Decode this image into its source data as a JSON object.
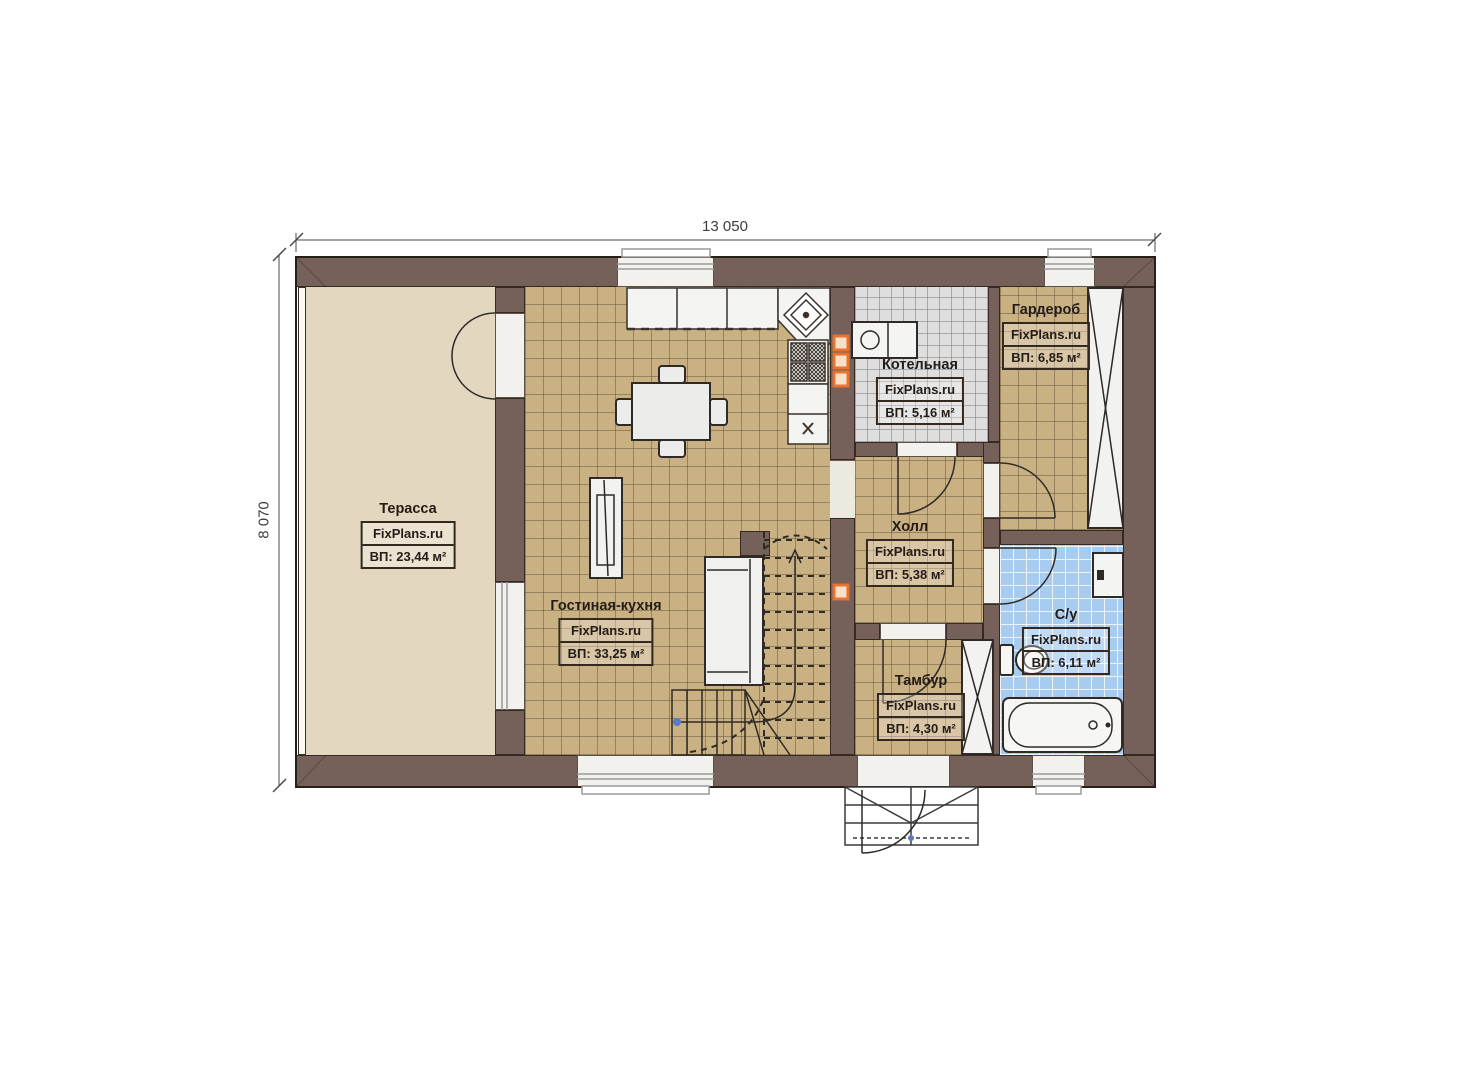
{
  "plan": {
    "type": "floor-plan",
    "dimensions": {
      "width_label": "13 050",
      "height_label": "8 070"
    }
  },
  "dimensions": {
    "width_label": "13 050",
    "height_label": "8 070"
  },
  "branding": {
    "watermark": "FixPlans.ru"
  },
  "rooms": [
    {
      "id": "terrace",
      "name": "Терасса",
      "watermark": "FixPlans.ru",
      "area_label": "ВП: 23,44 м²"
    },
    {
      "id": "living-kitchen",
      "name": "Гостиная-кухня",
      "watermark": "FixPlans.ru",
      "area_label": "ВП: 33,25 м²"
    },
    {
      "id": "boiler-room",
      "name": "Котельная",
      "watermark": "FixPlans.ru",
      "area_label": "ВП: 5,16 м²"
    },
    {
      "id": "wardrobe",
      "name": "Гардероб",
      "watermark": "FixPlans.ru",
      "area_label": "ВП: 6,85 м²"
    },
    {
      "id": "hall",
      "name": "Холл",
      "watermark": "FixPlans.ru",
      "area_label": "ВП: 5,38 м²"
    },
    {
      "id": "vestibule",
      "name": "Тамбур",
      "watermark": "FixPlans.ru",
      "area_label": "ВП: 4,30 м²"
    },
    {
      "id": "bathroom",
      "name": "С/у",
      "watermark": "FixPlans.ru",
      "area_label": "ВП: 6,11 м²"
    }
  ],
  "colors": {
    "wall": "#75605a",
    "terrace_floor": "#e4d7c0",
    "tile_brown": "#c9b184",
    "tile_grey": "#dedede",
    "tile_blue": "#a8cbf0",
    "accent_orange": "#e8722e",
    "label_text": "#241c16",
    "background": "#ffffff"
  }
}
